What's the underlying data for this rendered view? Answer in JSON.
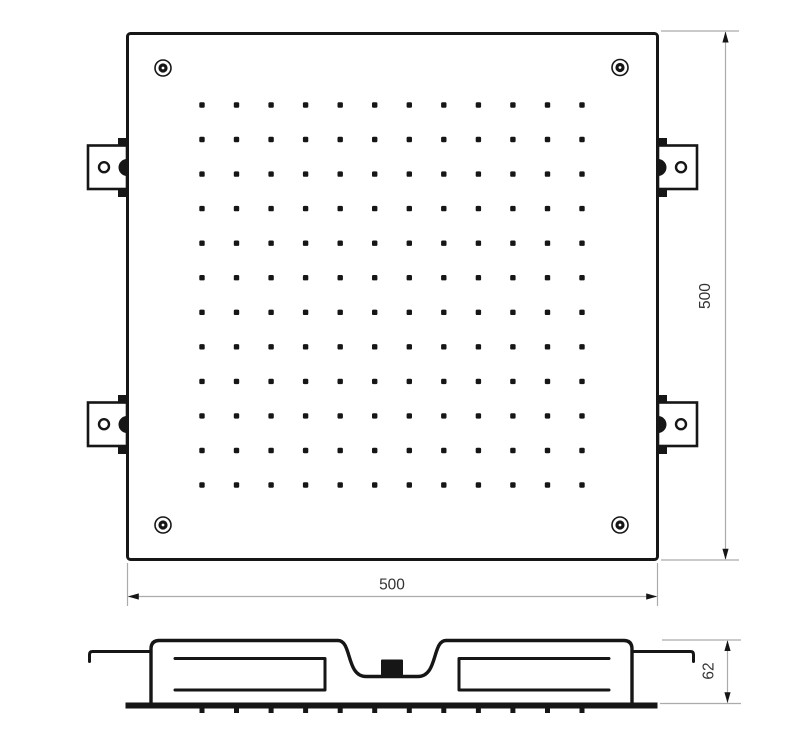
{
  "drawing": {
    "type": "technical-drawing",
    "subject": "square-ceiling-shower-head",
    "colors": {
      "background": "#ffffff",
      "line": "#161616",
      "dimension_line": "#ababab",
      "text": "#333333"
    }
  },
  "dimensions": {
    "top_width": {
      "label": "500"
    },
    "top_height": {
      "label": "500"
    },
    "side_height": {
      "label": "62"
    }
  },
  "nozzle_grid": {
    "rows": 12,
    "cols": 12
  },
  "side_nozzle_ticks": {
    "count": 12
  },
  "corner_screws": {
    "count": 4
  },
  "mounting_brackets": {
    "count": 4
  }
}
